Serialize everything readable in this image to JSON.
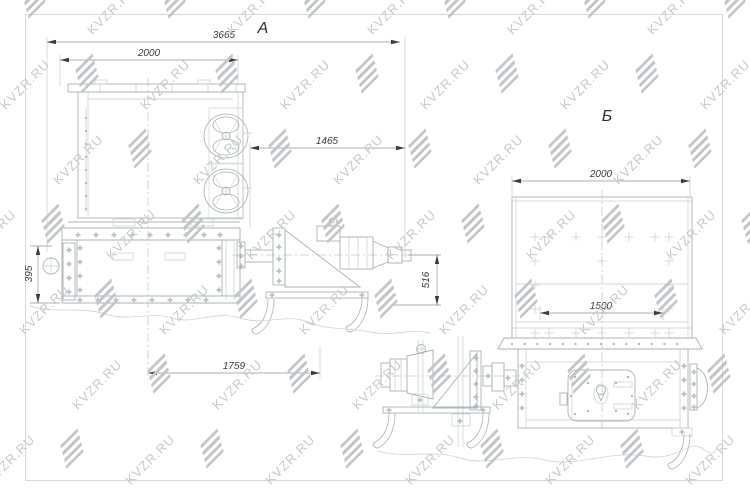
{
  "watermark": {
    "text": "KVZR.RU"
  },
  "colors": {
    "background": "#ffffff",
    "line": "#a9b3b5",
    "line_light": "#c6cfcf",
    "dim": "#8d9898",
    "dim_text": "#3c3c3c",
    "border": "#d4d9da",
    "watermark_text": "#c7cacd",
    "watermark_logo": "#c2c6c9"
  },
  "views": {
    "a": {
      "label": "А",
      "dim_overall_width": "3665",
      "dim_body_width": "2000",
      "dim_drive_length": "1465",
      "dim_frame_height": "395",
      "dim_drive_height": "516",
      "dim_base_length": "1759"
    },
    "b": {
      "label": "Б",
      "dim_body_width": "2000",
      "dim_opening_width": "1500"
    }
  }
}
